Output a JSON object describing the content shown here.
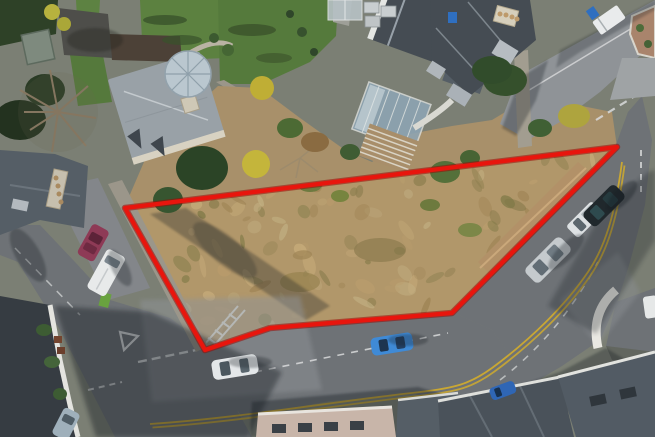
{
  "image": {
    "type": "aerial-drone-photograph",
    "subject": "Corner development plot of rough scrub land outlined in red beside a road junction with houses and parked cars",
    "width": 655,
    "height": 437
  },
  "boundary": {
    "points": "125,208 617,147 452,313 270,328 205,350",
    "color": "#e8150d",
    "underlay_color": "#9a0b06",
    "stroke_width": "4.2"
  },
  "palette": {
    "base": "#7b7f74",
    "plot_scrub": "#b1976a",
    "scrub_band": "#a8906a",
    "road": "#6e7276",
    "road_sunlit": "#8f9397",
    "lawn": "#5c8140",
    "lawn_dark": "#557a3c",
    "tree_dark": "#2b4426",
    "hedge": "#2e4127",
    "roof_dark": "#454c53",
    "roof_mid": "#555e66",
    "roof_light": "#99a1a7",
    "conservatory": "#bac7cf",
    "glass": "#8ea6b6",
    "wall_stone": "#9b968a",
    "pavement": "#83868a",
    "yellow_line": "#c9a733",
    "white_marking": "#d9dbdc",
    "shadow": "#161a20"
  },
  "vehicles": [
    {
      "name": "magenta-car-left-road",
      "color": "#8e3a56"
    },
    {
      "name": "white-van-left-road",
      "color": "#e8eaea"
    },
    {
      "name": "white-car-bottom-road",
      "color": "#e4e7e9"
    },
    {
      "name": "blue-car-bottom-road",
      "color": "#3f8ad6"
    },
    {
      "name": "silver-estate-right-road",
      "color": "#c5cacd"
    },
    {
      "name": "white-pickup-right-road",
      "color": "#dde1e3"
    },
    {
      "name": "black-suv-right-road",
      "color": "#20282c"
    },
    {
      "name": "blue-car-bottom-right",
      "color": "#2f66b5"
    },
    {
      "name": "grey-hatchback-bottom-left",
      "color": "#9fb0bb"
    },
    {
      "name": "white-truck-top-right",
      "color": "#e9ebec"
    }
  ]
}
